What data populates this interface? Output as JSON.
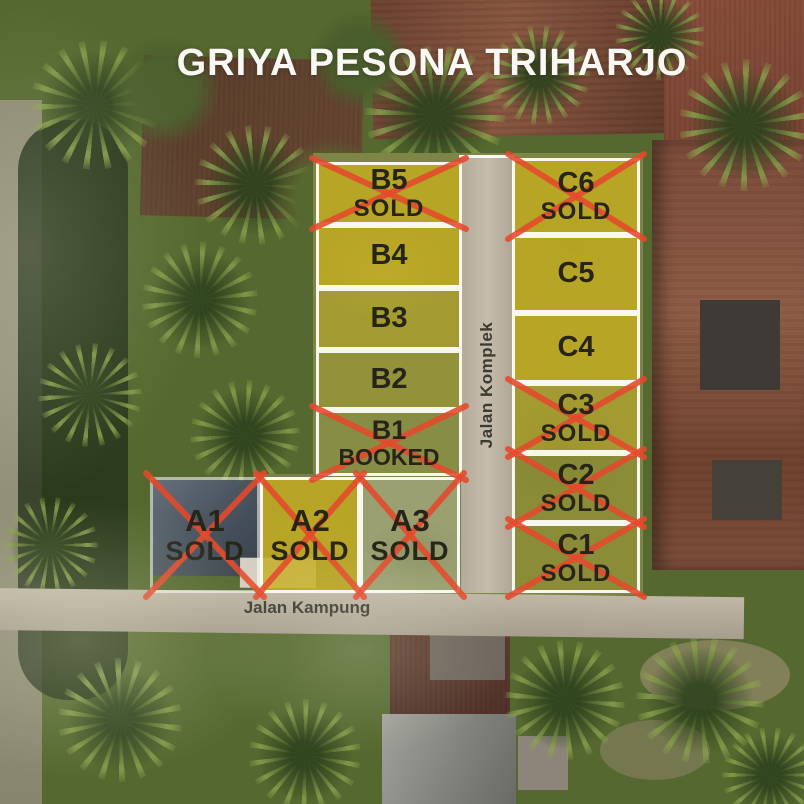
{
  "title": "GRIYA PESONA TRIHARJO",
  "roads": {
    "complex": "Jalan Komplek",
    "kampung": "Jalan Kampung"
  },
  "colors": {
    "plot_overlay_gold": "#C5AC1E",
    "sold_cross_red": "#E5492C",
    "plot_border_white": "#FFFFFF",
    "plot_text": "#27251A",
    "title_text": "#F9F8F4"
  },
  "plots": [
    {
      "id": "B5",
      "status": "SOLD"
    },
    {
      "id": "B4",
      "status": ""
    },
    {
      "id": "B3",
      "status": ""
    },
    {
      "id": "B2",
      "status": ""
    },
    {
      "id": "B1",
      "status": "BOOKED"
    },
    {
      "id": "C6",
      "status": "SOLD"
    },
    {
      "id": "C5",
      "status": ""
    },
    {
      "id": "C4",
      "status": ""
    },
    {
      "id": "C3",
      "status": "SOLD"
    },
    {
      "id": "C2",
      "status": "SOLD"
    },
    {
      "id": "C1",
      "status": "SOLD"
    },
    {
      "id": "A1",
      "status": "SOLD"
    },
    {
      "id": "A2",
      "status": "SOLD"
    },
    {
      "id": "A3",
      "status": "SOLD"
    }
  ]
}
